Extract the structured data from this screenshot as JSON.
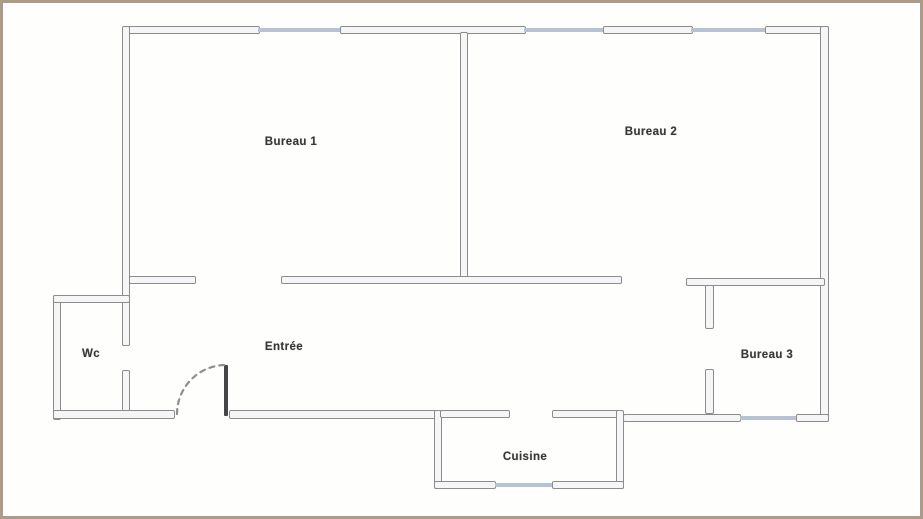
{
  "document": {
    "type": "scanned-floor-plan",
    "frame_color": "#ab9b88",
    "background": "#fefefd"
  },
  "palette": {
    "wall_line": "#8c8c90",
    "wall_fill": "#f6f6f6",
    "window": "#b7c2d2",
    "door": "#454547",
    "label": "#38383a"
  },
  "rooms": {
    "bureau1": {
      "label": "Bureau 1"
    },
    "bureau2": {
      "label": "Bureau 2"
    },
    "bureau3": {
      "label": "Bureau 3"
    },
    "wc": {
      "label": "Wc"
    },
    "entree": {
      "label": "Entrée"
    },
    "cuisine": {
      "label": "Cuisine"
    }
  }
}
